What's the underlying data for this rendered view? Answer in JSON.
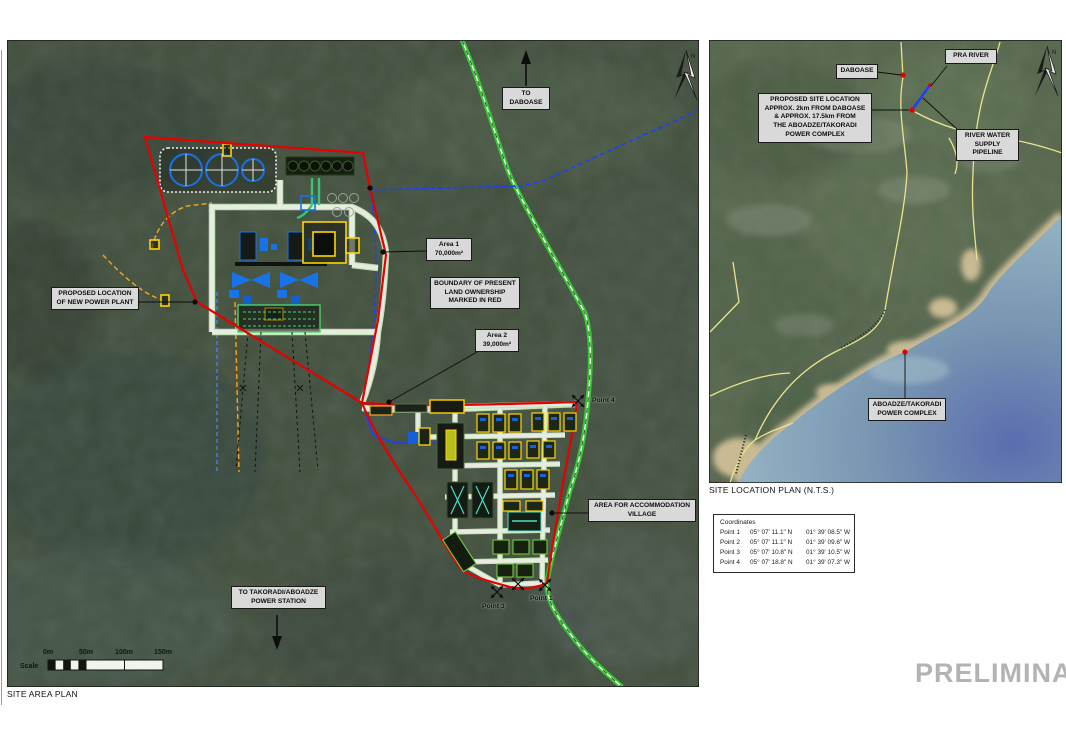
{
  "watermark": "PRELIMINARY",
  "site_area_plan": {
    "caption": "SITE AREA PLAN",
    "north_label": "N",
    "labels": {
      "to_daboase": "TO DABOASE",
      "proposed_location": "PROPOSED LOCATION\nOF NEW POWER PLANT",
      "area1": "Area 1\n70,000m²",
      "boundary_note": "BOUNDARY OF PRESENT\nLAND OWNERSHIP\nMARKED IN RED",
      "area2": "Area 2\n39,000m²",
      "accommodation": "AREA FOR ACCOMMODATION\nVILLAGE",
      "to_takoradi": "TO TAKORADI/ABOADZE\nPOWER STATION",
      "point1": "Point 1",
      "point3": "Point 3",
      "point4": "Point 4"
    },
    "scale": {
      "label": "Scale",
      "ticks": [
        "0m",
        "50m",
        "100m",
        "150m"
      ]
    }
  },
  "site_location_plan": {
    "caption": "SITE LOCATION PLAN (N.T.S.)",
    "north_label": "N",
    "labels": {
      "daboase": "DABOASE",
      "pra_river": "PRA RIVER",
      "proposed_site": "PROPOSED SITE LOCATION\nAPPROX. 2km FROM DABOASE\n& APPROX. 17.5km FROM\nTHE ABOADZE/TAKORADI\nPOWER COMPLEX",
      "river_water": "RIVER WATER\nSUPPLY PIPELINE",
      "aboadze": "ABOADZE/TAKORADI\nPOWER COMPLEX"
    }
  },
  "coordinates_table": {
    "title": "Coordinates",
    "rows": [
      {
        "point": "Point 1",
        "lat": "05° 07' 11.1\" N",
        "lon": "01° 39' 08.5\" W"
      },
      {
        "point": "Point 2",
        "lat": "05° 07' 11.1\" N",
        "lon": "01° 39' 09.6\" W"
      },
      {
        "point": "Point 3",
        "lat": "05° 07' 10.8\" N",
        "lon": "01° 39' 10.5\" W"
      },
      {
        "point": "Point 4",
        "lat": "05° 07' 18.8\" N",
        "lon": "01° 39' 07.3\" W"
      }
    ]
  },
  "colors": {
    "boundary_red": "#e60000",
    "road_green": "#2fc82f",
    "pipeline_blue": "#1a3fff",
    "machinery_blue": "#1873e8",
    "route_orange": "#f5a623",
    "building_yellow": "#ffd400",
    "label_bg": "#d9d9d9",
    "watermark_gray": "#b3b3b3"
  }
}
